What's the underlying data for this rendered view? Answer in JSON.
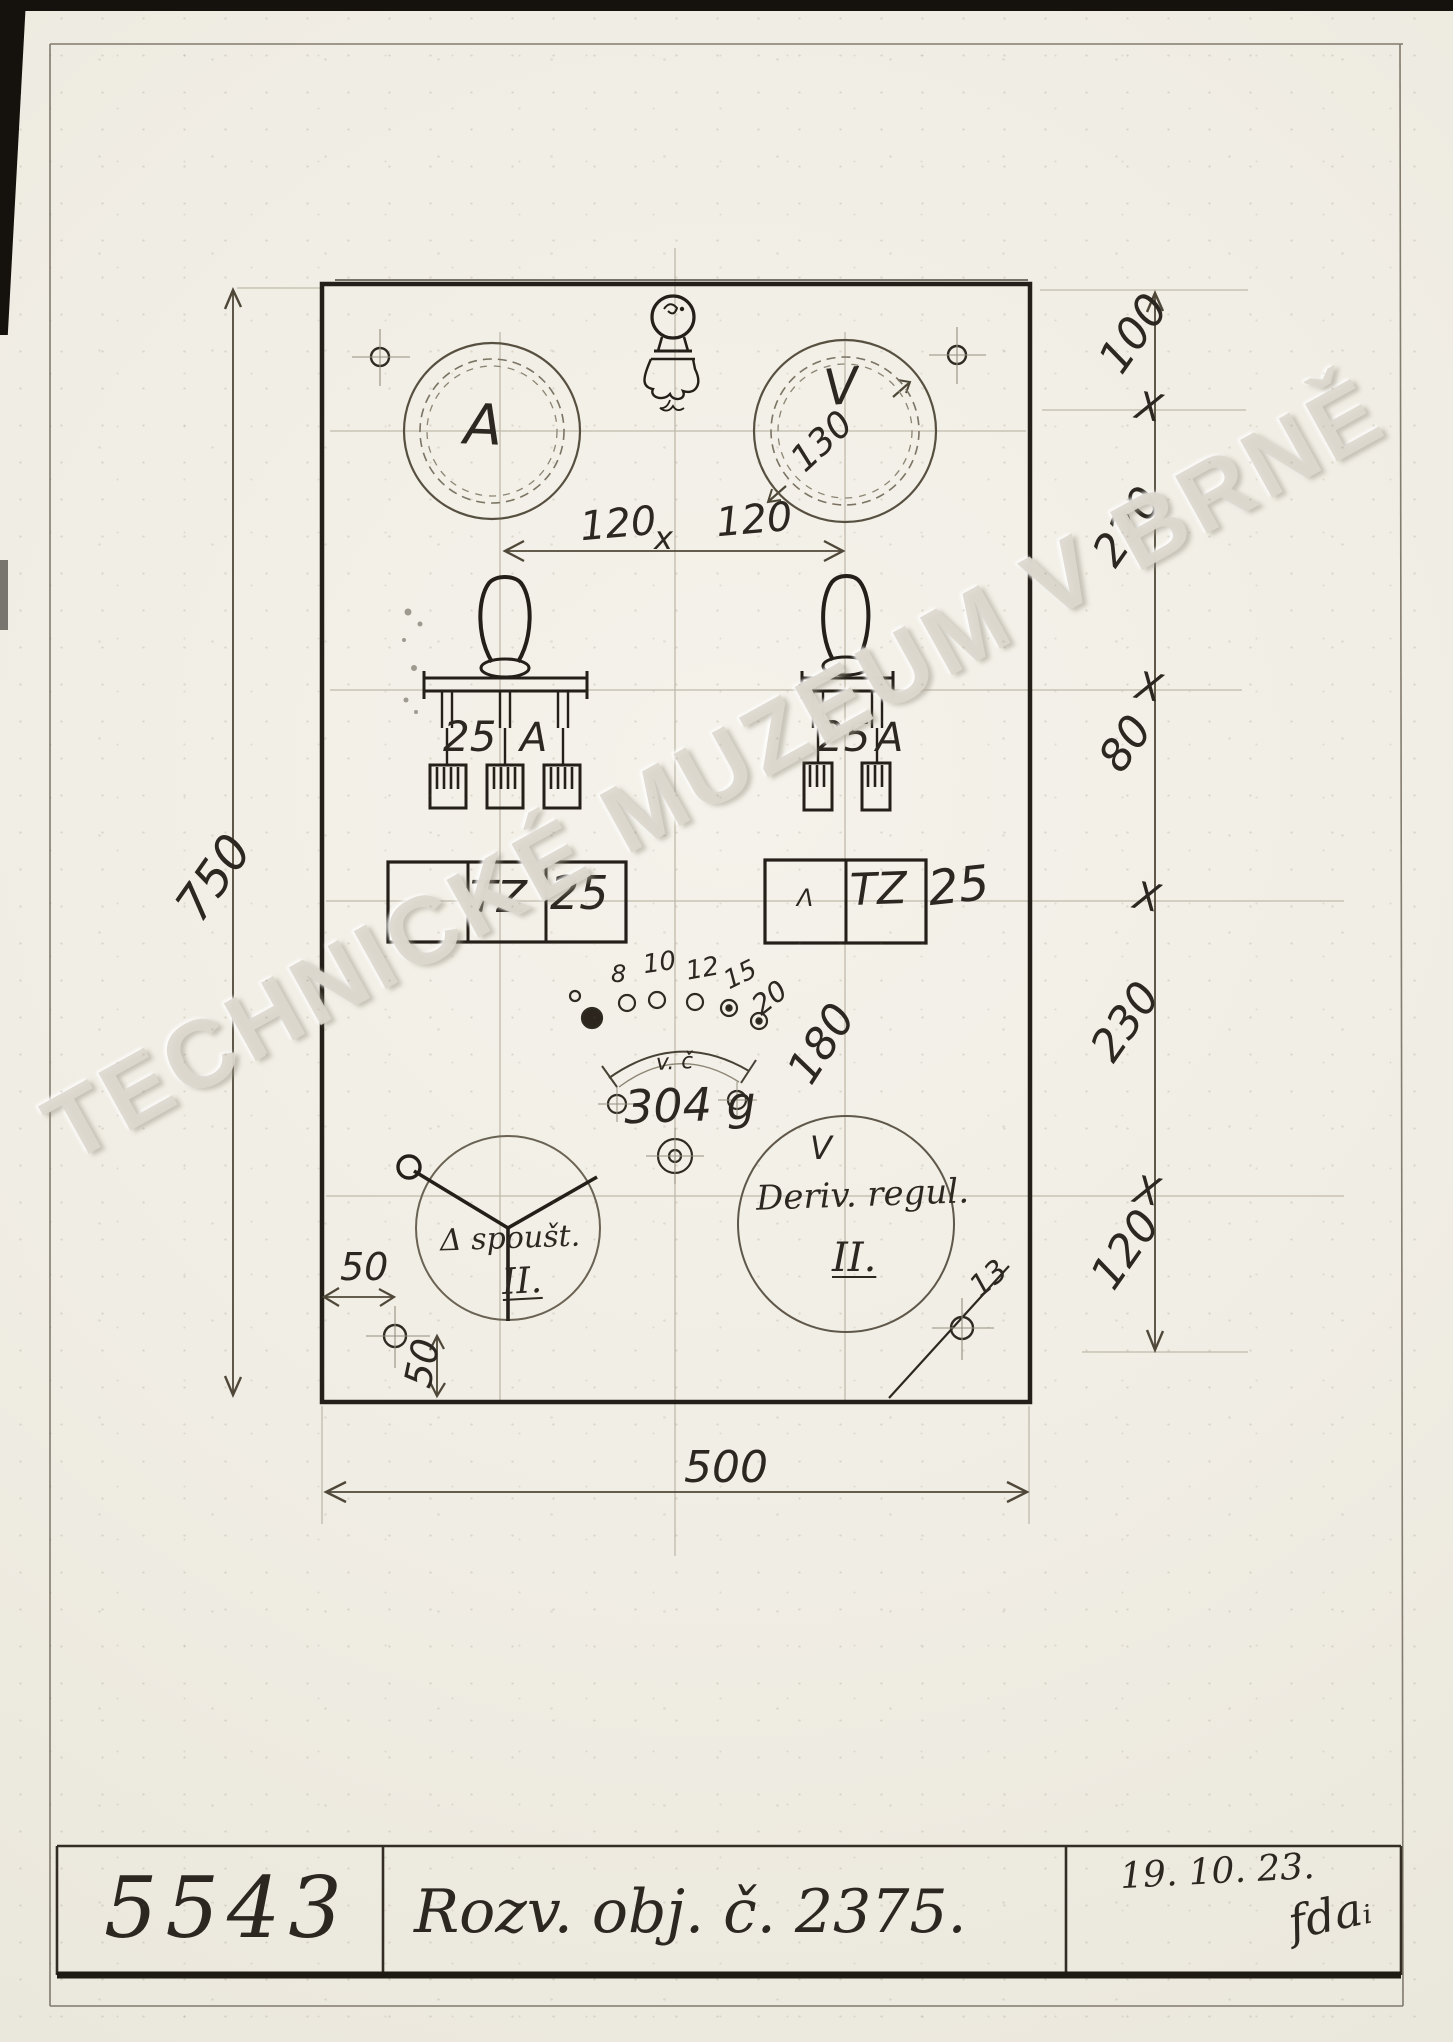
{
  "sheet": {
    "watermark": "TECHNICKÉ MUZEUM V BRNĚ"
  },
  "title_block": {
    "drawing_number": "5543",
    "title": "Rozv. obj. č. 2375.",
    "date": "19. 10. 23.",
    "signature": "fdaᵢ"
  },
  "panel": {
    "ammeter_label": "A",
    "voltmeter_label": "V",
    "voltmeter_diameter": "130",
    "meter_spacing": {
      "left": "120",
      "sep": "x",
      "right": "120"
    },
    "switch_left": {
      "rating": "25",
      "unit": "A"
    },
    "switch_right": {
      "rating": "25",
      "unit": "A"
    },
    "fuse_left": {
      "type": "TZ",
      "rating": "25"
    },
    "fuse_right": {
      "mark": "Λ",
      "type": "TZ",
      "rating": "25"
    },
    "dial": {
      "ticks": [
        "8",
        "10",
        "12",
        "15",
        "20"
      ],
      "arc_label": "v. č",
      "sweep_angle": "180",
      "part_label": "304 g"
    },
    "starter": {
      "line1": "Δ spoušt.",
      "line2": "II."
    },
    "regulator": {
      "mark": "V",
      "line1": "Deriv. regul.",
      "line2": "II."
    },
    "hole_diameter": "13"
  },
  "dimensions": {
    "height_total": "750",
    "width_total": "500",
    "right_chain": [
      "100",
      "220",
      "80",
      "230",
      "120"
    ],
    "chain_separator": "X",
    "hole_offset_h": "50",
    "hole_offset_v": "50"
  }
}
